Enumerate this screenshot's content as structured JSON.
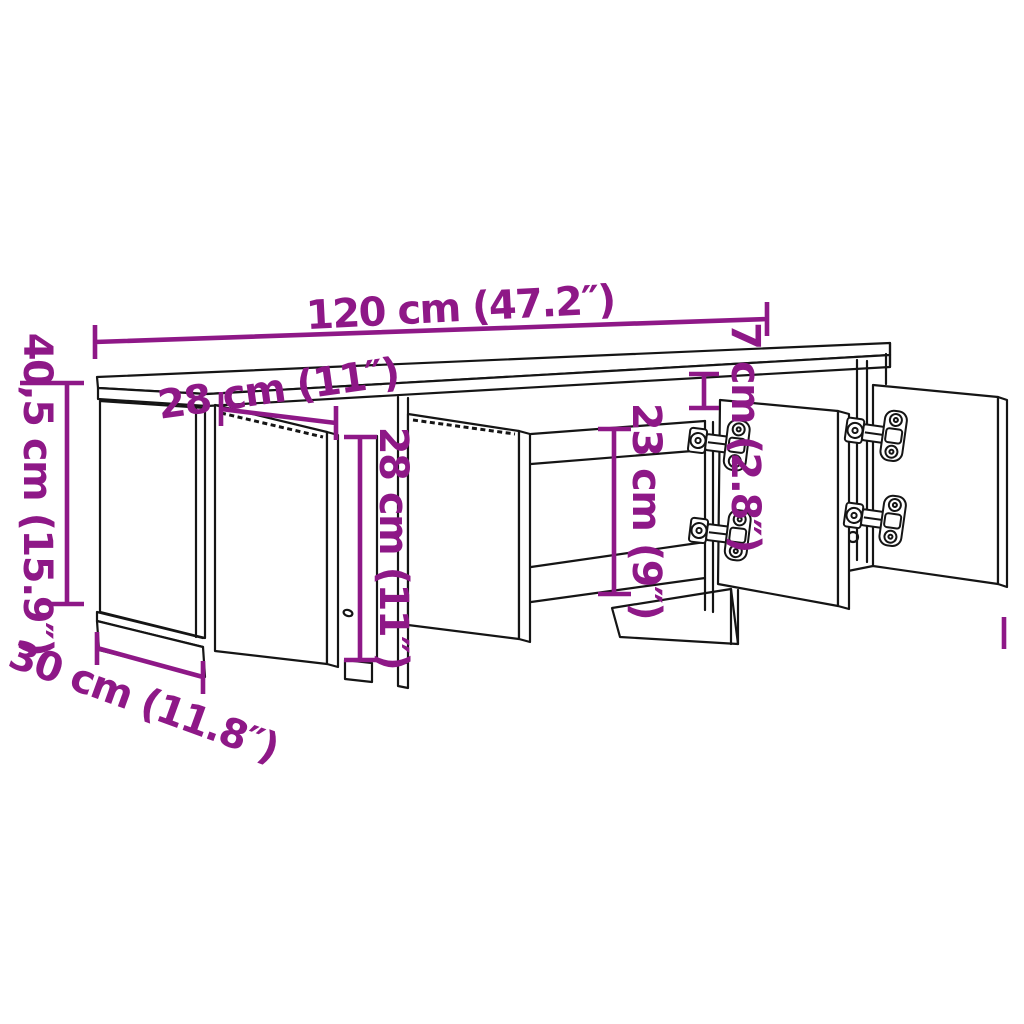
{
  "diagram": {
    "background_color": "#ffffff",
    "outline_color": "#151515",
    "dimension_color": "#8E1887",
    "subject": "TV cabinet line drawing with four open doors and concealed hinges"
  },
  "dimensions": {
    "overall_width": {
      "label": "120 cm (47.2″)"
    },
    "top_depth": {
      "label": "28 cm (11″)"
    },
    "overall_height": {
      "label": "40,5 cm (15.9″)"
    },
    "base_depth": {
      "label": "30 cm (11.8″)"
    },
    "door_height": {
      "label": "28 cm (11″)"
    },
    "compartment_height": {
      "label": "23 cm (9″)"
    },
    "top_panel_height": {
      "label": "7 cm (2.8″)"
    }
  }
}
